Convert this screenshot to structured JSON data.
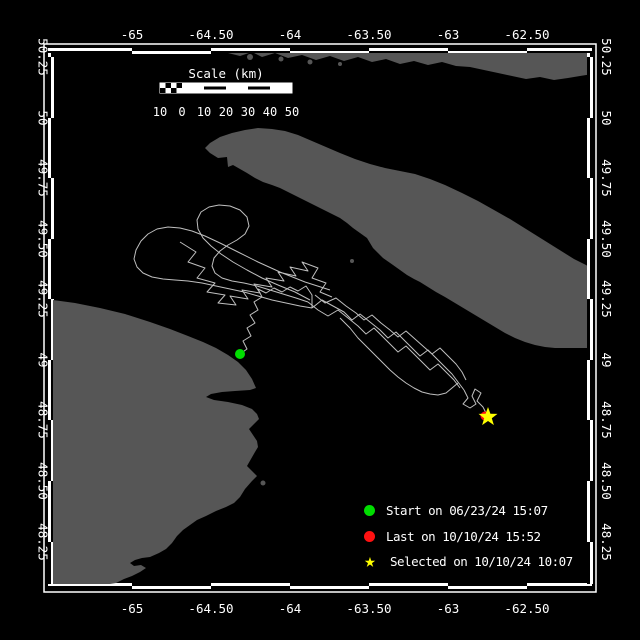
{
  "colors": {
    "background": "#000000",
    "land": "#565656",
    "track": "#bfbfbf",
    "frame": "#ffffff",
    "start": "#00dd00",
    "last": "#ff1111",
    "selected": "#ffff00",
    "text": "#ffffff"
  },
  "frame": {
    "outer": {
      "x": 44,
      "y": 44,
      "w": 552,
      "h": 548
    },
    "band": {
      "left": 48,
      "top": 48,
      "right": 592,
      "bottom": 588,
      "thickness": 6
    },
    "lon_ticks": [
      {
        "label": "-65",
        "x": 132
      },
      {
        "label": "-64.50",
        "x": 211
      },
      {
        "label": "-64",
        "x": 290
      },
      {
        "label": "-63.50",
        "x": 369
      },
      {
        "label": "-63",
        "x": 448
      },
      {
        "label": "-62.50",
        "x": 527
      }
    ],
    "lat_ticks": [
      {
        "label": "50.25",
        "y": 57
      },
      {
        "label": "50",
        "y": 118
      },
      {
        "label": "49.75",
        "y": 178
      },
      {
        "label": "49.50",
        "y": 239
      },
      {
        "label": "49.25",
        "y": 299
      },
      {
        "label": "49",
        "y": 360
      },
      {
        "label": "48.75",
        "y": 420
      },
      {
        "label": "48.50",
        "y": 481
      },
      {
        "label": "48.25",
        "y": 542
      }
    ]
  },
  "scalebar": {
    "title": "Scale (km)",
    "labels": [
      "10",
      "0",
      "10",
      "20",
      "30",
      "40",
      "50"
    ],
    "x0": 160,
    "y": 83,
    "seg_px": 22,
    "height": 10,
    "title_y": 78,
    "labels_y": 116
  },
  "legend": {
    "rows": [
      {
        "marker": "circle",
        "color": "#00dd00",
        "label": "Start on 06/23/24 15:07"
      },
      {
        "marker": "circle",
        "color": "#ff1111",
        "label": "Last on 10/10/24 15:52"
      },
      {
        "marker": "star",
        "color": "#ffff00",
        "label": "Selected on 10/10/24 10:07"
      }
    ],
    "star_char": "★"
  },
  "markers": {
    "start": {
      "x": 240,
      "y": 354
    },
    "last": {
      "x": 485,
      "y": 416
    },
    "selected": {
      "x": 488,
      "y": 417
    }
  },
  "land": {
    "north_shore": [
      [
        228,
        53
      ],
      [
        240,
        56
      ],
      [
        252,
        52
      ],
      [
        262,
        57
      ],
      [
        275,
        53
      ],
      [
        288,
        58
      ],
      [
        302,
        55
      ],
      [
        316,
        60
      ],
      [
        330,
        56
      ],
      [
        344,
        61
      ],
      [
        358,
        57
      ],
      [
        372,
        62
      ],
      [
        386,
        59
      ],
      [
        400,
        64
      ],
      [
        414,
        61
      ],
      [
        428,
        65
      ],
      [
        442,
        62
      ],
      [
        456,
        66
      ],
      [
        470,
        67
      ],
      [
        484,
        70
      ],
      [
        498,
        73
      ],
      [
        512,
        76
      ],
      [
        526,
        79
      ],
      [
        540,
        77
      ],
      [
        554,
        80
      ],
      [
        568,
        78
      ],
      [
        580,
        76
      ],
      [
        592,
        74
      ],
      [
        592,
        53
      ]
    ],
    "north_islands": [
      [
        250,
        57,
        3
      ],
      [
        281,
        59,
        2.5
      ],
      [
        310,
        62,
        2.5
      ],
      [
        340,
        64,
        2
      ]
    ],
    "anticosti": [
      [
        205,
        148
      ],
      [
        210,
        143
      ],
      [
        220,
        137
      ],
      [
        232,
        133
      ],
      [
        245,
        130
      ],
      [
        258,
        128
      ],
      [
        272,
        129
      ],
      [
        285,
        131
      ],
      [
        298,
        135
      ],
      [
        312,
        141
      ],
      [
        326,
        147
      ],
      [
        340,
        153
      ],
      [
        355,
        159
      ],
      [
        370,
        164
      ],
      [
        385,
        168
      ],
      [
        400,
        171
      ],
      [
        415,
        174
      ],
      [
        430,
        179
      ],
      [
        445,
        185
      ],
      [
        462,
        193
      ],
      [
        478,
        201
      ],
      [
        494,
        210
      ],
      [
        510,
        219
      ],
      [
        526,
        229
      ],
      [
        542,
        239
      ],
      [
        558,
        249
      ],
      [
        574,
        259
      ],
      [
        586,
        265
      ],
      [
        592,
        269
      ],
      [
        592,
        348
      ],
      [
        585,
        348
      ],
      [
        575,
        348
      ],
      [
        565,
        348
      ],
      [
        555,
        348
      ],
      [
        545,
        347
      ],
      [
        535,
        345
      ],
      [
        525,
        342
      ],
      [
        515,
        338
      ],
      [
        505,
        333
      ],
      [
        495,
        327
      ],
      [
        485,
        321
      ],
      [
        475,
        315
      ],
      [
        465,
        309
      ],
      [
        455,
        303
      ],
      [
        445,
        297
      ],
      [
        436,
        292
      ],
      [
        428,
        287
      ],
      [
        420,
        282
      ],
      [
        414,
        279
      ],
      [
        407,
        275
      ],
      [
        400,
        270
      ],
      [
        393,
        265
      ],
      [
        383,
        258
      ],
      [
        378,
        253
      ],
      [
        373,
        248
      ],
      [
        367,
        238
      ],
      [
        360,
        233
      ],
      [
        353,
        228
      ],
      [
        347,
        223
      ],
      [
        340,
        218
      ],
      [
        330,
        213
      ],
      [
        320,
        208
      ],
      [
        310,
        203
      ],
      [
        300,
        198
      ],
      [
        290,
        193
      ],
      [
        280,
        188
      ],
      [
        272,
        185
      ],
      [
        263,
        182
      ],
      [
        255,
        178
      ],
      [
        247,
        173
      ],
      [
        240,
        169
      ],
      [
        233,
        165
      ],
      [
        228,
        167
      ],
      [
        227,
        157
      ],
      [
        218,
        158
      ],
      [
        210,
        153
      ]
    ],
    "gaspe": [
      [
        53,
        300
      ],
      [
        75,
        303
      ],
      [
        100,
        308
      ],
      [
        125,
        314
      ],
      [
        150,
        322
      ],
      [
        170,
        329
      ],
      [
        188,
        336
      ],
      [
        203,
        342
      ],
      [
        216,
        348
      ],
      [
        228,
        355
      ],
      [
        238,
        362
      ],
      [
        246,
        370
      ],
      [
        252,
        379
      ],
      [
        256,
        388
      ],
      [
        250,
        390
      ],
      [
        235,
        391
      ],
      [
        222,
        392
      ],
      [
        211,
        394
      ],
      [
        206,
        397
      ],
      [
        214,
        400
      ],
      [
        228,
        402
      ],
      [
        242,
        405
      ],
      [
        252,
        409
      ],
      [
        257,
        414
      ],
      [
        259,
        419
      ],
      [
        254,
        424
      ],
      [
        249,
        429
      ],
      [
        253,
        435
      ],
      [
        257,
        441
      ],
      [
        258,
        447
      ],
      [
        255,
        452
      ],
      [
        251,
        459
      ],
      [
        247,
        466
      ],
      [
        252,
        471
      ],
      [
        257,
        476
      ],
      [
        252,
        481
      ],
      [
        245,
        489
      ],
      [
        240,
        497
      ],
      [
        234,
        503
      ],
      [
        226,
        507
      ],
      [
        216,
        511
      ],
      [
        206,
        516
      ],
      [
        197,
        520
      ],
      [
        190,
        525
      ],
      [
        183,
        530
      ],
      [
        177,
        536
      ],
      [
        172,
        543
      ],
      [
        166,
        549
      ],
      [
        159,
        553
      ],
      [
        150,
        557
      ],
      [
        142,
        558
      ],
      [
        135,
        560
      ],
      [
        130,
        563
      ],
      [
        134,
        566
      ],
      [
        141,
        565
      ],
      [
        146,
        568
      ],
      [
        140,
        572
      ],
      [
        132,
        576
      ],
      [
        124,
        579
      ],
      [
        116,
        583
      ],
      [
        110,
        584
      ],
      [
        53,
        584
      ]
    ],
    "islets": [
      [
        263,
        483,
        2.5
      ],
      [
        352,
        261,
        2
      ]
    ]
  },
  "track": {
    "strands": [
      [
        [
          240,
          354
        ],
        [
          247,
          349
        ],
        [
          243,
          341
        ],
        [
          251,
          336
        ],
        [
          247,
          328
        ],
        [
          255,
          323
        ],
        [
          250,
          315
        ],
        [
          258,
          310
        ],
        [
          254,
          302
        ],
        [
          262,
          297
        ],
        [
          258,
          289
        ],
        [
          266,
          293
        ],
        [
          274,
          288
        ],
        [
          282,
          292
        ],
        [
          290,
          287
        ],
        [
          298,
          291
        ],
        [
          306,
          286
        ],
        [
          312,
          295
        ],
        [
          312,
          308
        ]
      ],
      [
        [
          330,
          290
        ],
        [
          305,
          282
        ],
        [
          280,
          272
        ],
        [
          258,
          262
        ],
        [
          238,
          252
        ],
        [
          220,
          243
        ],
        [
          205,
          236
        ],
        [
          192,
          231
        ],
        [
          180,
          228
        ],
        [
          168,
          227
        ],
        [
          157,
          229
        ],
        [
          148,
          234
        ],
        [
          141,
          241
        ],
        [
          136,
          250
        ],
        [
          134,
          259
        ],
        [
          137,
          267
        ],
        [
          143,
          273
        ],
        [
          152,
          277
        ],
        [
          163,
          279
        ],
        [
          175,
          280
        ],
        [
          188,
          281
        ],
        [
          202,
          283
        ],
        [
          216,
          286
        ],
        [
          230,
          289
        ],
        [
          244,
          292
        ],
        [
          258,
          296
        ],
        [
          272,
          300
        ],
        [
          286,
          303
        ],
        [
          300,
          306
        ],
        [
          312,
          308
        ]
      ],
      [
        [
          310,
          300
        ],
        [
          295,
          292
        ],
        [
          278,
          285
        ],
        [
          262,
          278
        ],
        [
          247,
          270
        ],
        [
          233,
          262
        ],
        [
          221,
          254
        ],
        [
          211,
          246
        ],
        [
          203,
          238
        ],
        [
          198,
          229
        ],
        [
          197,
          220
        ],
        [
          201,
          212
        ],
        [
          209,
          207
        ],
        [
          219,
          205
        ],
        [
          230,
          206
        ],
        [
          240,
          210
        ],
        [
          247,
          217
        ],
        [
          249,
          226
        ],
        [
          245,
          234
        ],
        [
          237,
          240
        ],
        [
          228,
          245
        ],
        [
          220,
          251
        ],
        [
          214,
          258
        ],
        [
          212,
          266
        ],
        [
          215,
          273
        ],
        [
          222,
          278
        ],
        [
          232,
          281
        ],
        [
          244,
          283
        ],
        [
          257,
          286
        ],
        [
          270,
          290
        ],
        [
          283,
          294
        ],
        [
          296,
          298
        ],
        [
          308,
          302
        ]
      ],
      [
        [
          180,
          242
        ],
        [
          196,
          252
        ],
        [
          188,
          262
        ],
        [
          205,
          268
        ],
        [
          197,
          278
        ],
        [
          215,
          283
        ],
        [
          207,
          292
        ],
        [
          225,
          295
        ],
        [
          218,
          303
        ],
        [
          236,
          305
        ],
        [
          230,
          296
        ],
        [
          248,
          299
        ],
        [
          242,
          290
        ],
        [
          260,
          293
        ],
        [
          254,
          284
        ],
        [
          272,
          287
        ],
        [
          266,
          278
        ],
        [
          284,
          281
        ],
        [
          278,
          272
        ],
        [
          296,
          276
        ],
        [
          290,
          267
        ],
        [
          308,
          271
        ],
        [
          302,
          262
        ],
        [
          318,
          268
        ],
        [
          312,
          278
        ],
        [
          326,
          283
        ],
        [
          320,
          292
        ],
        [
          332,
          297
        ]
      ],
      [
        [
          312,
          308
        ],
        [
          322,
          300
        ],
        [
          333,
          306
        ],
        [
          344,
          312
        ],
        [
          352,
          320
        ],
        [
          360,
          314
        ],
        [
          370,
          322
        ],
        [
          380,
          330
        ],
        [
          388,
          338
        ],
        [
          396,
          332
        ],
        [
          404,
          340
        ],
        [
          412,
          348
        ],
        [
          420,
          356
        ],
        [
          428,
          350
        ],
        [
          436,
          358
        ],
        [
          444,
          366
        ],
        [
          452,
          374
        ],
        [
          458,
          382
        ],
        [
          464,
          390
        ]
      ],
      [
        [
          308,
          302
        ],
        [
          318,
          310
        ],
        [
          328,
          316
        ],
        [
          338,
          310
        ],
        [
          348,
          318
        ],
        [
          358,
          326
        ],
        [
          366,
          334
        ],
        [
          374,
          328
        ],
        [
          382,
          336
        ],
        [
          390,
          344
        ],
        [
          398,
          352
        ],
        [
          406,
          346
        ],
        [
          414,
          354
        ],
        [
          422,
          362
        ],
        [
          430,
          370
        ],
        [
          438,
          364
        ],
        [
          446,
          372
        ],
        [
          454,
          380
        ],
        [
          460,
          388
        ]
      ],
      [
        [
          315,
          295
        ],
        [
          325,
          303
        ],
        [
          336,
          298
        ],
        [
          346,
          306
        ],
        [
          356,
          313
        ],
        [
          364,
          320
        ],
        [
          372,
          315
        ],
        [
          381,
          323
        ],
        [
          390,
          330
        ],
        [
          398,
          337
        ],
        [
          406,
          331
        ],
        [
          415,
          339
        ],
        [
          424,
          347
        ],
        [
          432,
          354
        ],
        [
          440,
          348
        ],
        [
          448,
          356
        ],
        [
          456,
          364
        ],
        [
          462,
          372
        ],
        [
          466,
          380
        ]
      ],
      [
        [
          340,
          318
        ],
        [
          350,
          328
        ],
        [
          358,
          338
        ],
        [
          366,
          346
        ],
        [
          374,
          354
        ],
        [
          382,
          362
        ],
        [
          390,
          370
        ],
        [
          398,
          377
        ],
        [
          406,
          383
        ],
        [
          414,
          388
        ],
        [
          422,
          392
        ],
        [
          430,
          394
        ],
        [
          438,
          395
        ],
        [
          446,
          393
        ],
        [
          452,
          388
        ],
        [
          458,
          383
        ]
      ],
      [
        [
          464,
          390
        ],
        [
          468,
          398
        ],
        [
          463,
          404
        ],
        [
          470,
          408
        ],
        [
          476,
          404
        ],
        [
          472,
          396
        ],
        [
          475,
          389
        ],
        [
          481,
          393
        ],
        [
          477,
          401
        ],
        [
          483,
          407
        ],
        [
          486,
          413
        ],
        [
          488,
          417
        ]
      ]
    ]
  }
}
